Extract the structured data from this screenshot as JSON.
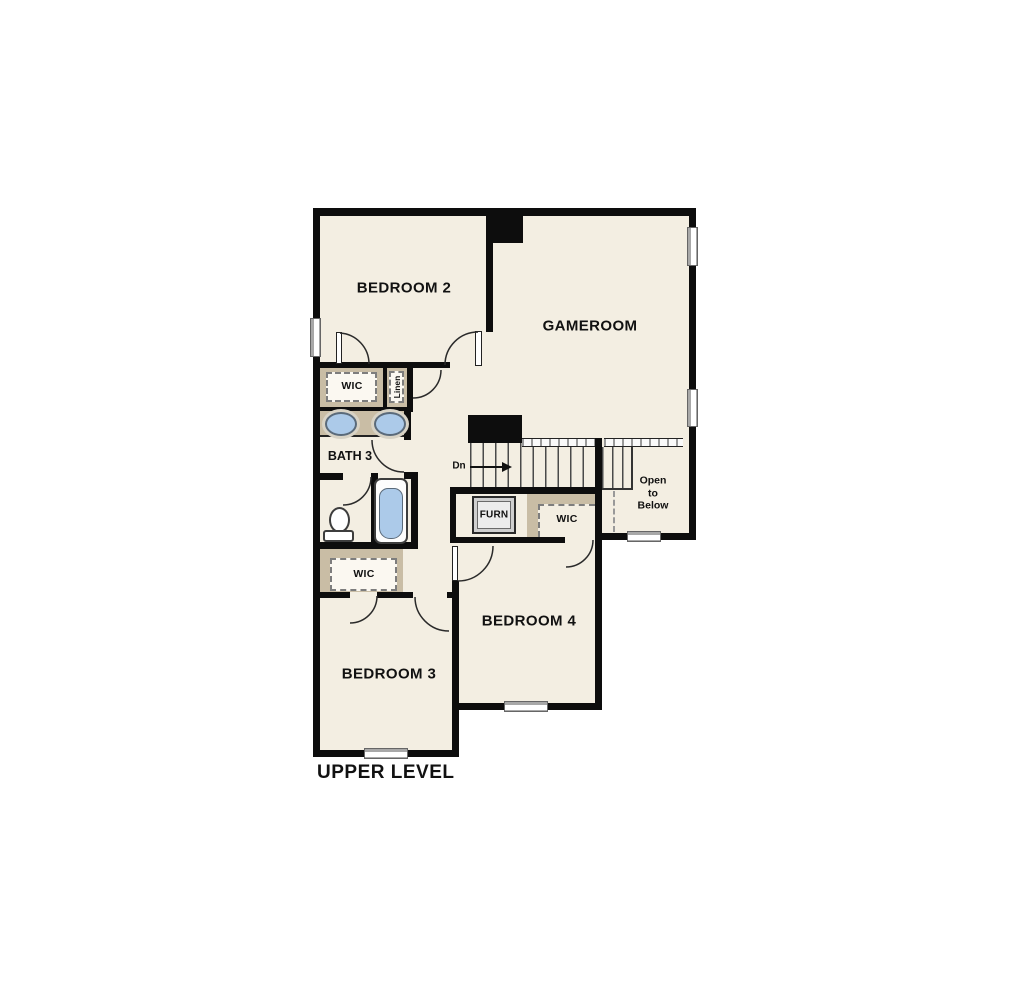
{
  "title": "UPPER LEVEL",
  "rooms": {
    "bedroom2": {
      "label": "BEDROOM 2"
    },
    "gameroom": {
      "label": "GAMEROOM"
    },
    "bath3": {
      "label": "BATH 3"
    },
    "bedroom3": {
      "label": "BEDROOM 3"
    },
    "bedroom4": {
      "label": "BEDROOM 4"
    }
  },
  "closets": {
    "wic_bath": {
      "label": "WIC"
    },
    "linen": {
      "label": "Linen"
    },
    "wic_bed3": {
      "label": "WIC"
    },
    "wic_bed4": {
      "label": "WIC"
    }
  },
  "stairs": {
    "down_label": "Dn"
  },
  "utility": {
    "furnace_label": "FURN"
  },
  "void_area": {
    "line1": "Open",
    "line2": "to",
    "line3": "Below"
  },
  "colors": {
    "floor": "#f3eee2",
    "tan": "#c9bda5",
    "wall": "#0d0d0d",
    "fixture": "#accae9",
    "wingray": "#a8a8a8"
  }
}
